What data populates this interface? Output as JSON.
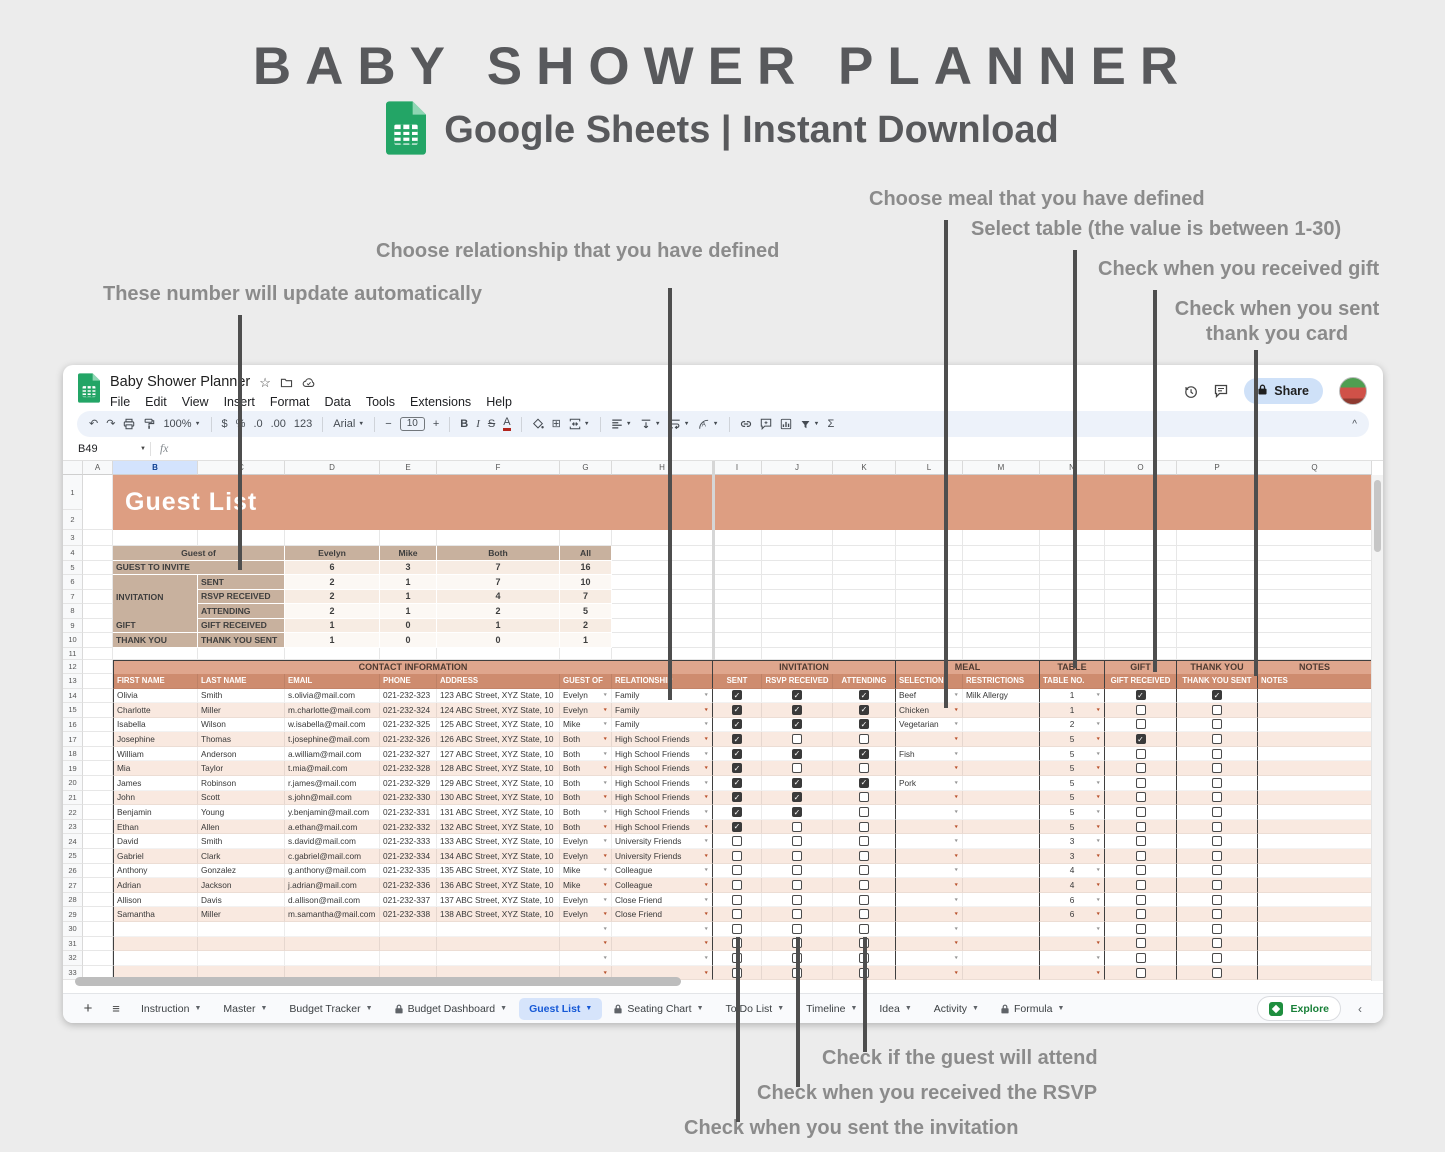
{
  "page": {
    "title": "BABY SHOWER PLANNER",
    "subtitle": "Google Sheets | Instant Download"
  },
  "annotations": {
    "auto_update": "These number will update automatically",
    "relationship": "Choose relationship that you have defined",
    "meal": "Choose meal that you have defined",
    "table": "Select table (the value is between 1-30)",
    "gift": "Check when you received gift",
    "thank_you": "Check when you sent thank you card",
    "attend": "Check if the guest will attend",
    "rsvp": "Check when you received the RSVP",
    "invitation": "Check when you sent the invitation"
  },
  "app": {
    "doc_title": "Baby Shower Planner",
    "menus": [
      "File",
      "Edit",
      "View",
      "Insert",
      "Format",
      "Data",
      "Tools",
      "Extensions",
      "Help"
    ],
    "share_label": "Share",
    "name_box": "B49",
    "fx_label": "fx"
  },
  "toolbar": {
    "items": [
      {
        "name": "undo-icon",
        "glyph": "↶"
      },
      {
        "name": "redo-icon",
        "glyph": "↷"
      },
      {
        "name": "print-icon",
        "svg": "print"
      },
      {
        "name": "paint-format-icon",
        "svg": "paint"
      },
      {
        "name": "zoom-select",
        "text": "100%",
        "caret": true
      },
      {
        "name": "sep"
      },
      {
        "name": "currency-format-icon",
        "glyph": "$"
      },
      {
        "name": "percent-format-icon",
        "glyph": "%"
      },
      {
        "name": "decrease-decimal-icon",
        "glyph": ".0"
      },
      {
        "name": "increase-decimal-icon",
        "glyph": ".00"
      },
      {
        "name": "number-format-select",
        "glyph": "123"
      },
      {
        "name": "sep"
      },
      {
        "name": "font-select",
        "text": "Arial",
        "caret": true
      },
      {
        "name": "sep"
      },
      {
        "name": "decrease-font-size-icon",
        "glyph": "−"
      },
      {
        "name": "font-size-input",
        "text": "10",
        "boxed": true
      },
      {
        "name": "increase-font-size-icon",
        "glyph": "+"
      },
      {
        "name": "sep"
      },
      {
        "name": "bold-icon",
        "glyph": "B",
        "style": "b"
      },
      {
        "name": "italic-icon",
        "glyph": "I",
        "style": "i"
      },
      {
        "name": "strikethrough-icon",
        "glyph": "S",
        "style": "strike"
      },
      {
        "name": "text-color-icon",
        "glyph": "A",
        "style": "underbar"
      },
      {
        "name": "sep"
      },
      {
        "name": "fill-color-icon",
        "svg": "fill"
      },
      {
        "name": "borders-icon",
        "glyph": "⊞"
      },
      {
        "name": "merge-cells-icon",
        "svg": "merge",
        "caret": true
      },
      {
        "name": "sep"
      },
      {
        "name": "horizontal-align-icon",
        "svg": "halign",
        "caret": true
      },
      {
        "name": "vertical-align-icon",
        "svg": "valign",
        "caret": true
      },
      {
        "name": "text-wrap-icon",
        "svg": "wrap",
        "caret": true
      },
      {
        "name": "text-rotation-icon",
        "svg": "rotate",
        "caret": true
      },
      {
        "name": "sep"
      },
      {
        "name": "insert-link-icon",
        "svg": "link"
      },
      {
        "name": "insert-comment-icon",
        "svg": "comment"
      },
      {
        "name": "insert-chart-icon",
        "svg": "chart"
      },
      {
        "name": "filter-icon",
        "svg": "filter",
        "caret": true
      },
      {
        "name": "functions-icon",
        "glyph": "Σ"
      }
    ],
    "collapse_glyph": "^"
  },
  "grid": {
    "columns": [
      "A",
      "B",
      "C",
      "D",
      "E",
      "F",
      "G",
      "H",
      "I",
      "J",
      "K",
      "L",
      "M",
      "N",
      "O",
      "P",
      "Q"
    ],
    "selected_column": "B",
    "sheet_title": "Guest List",
    "first_row": 1,
    "last_row": 33
  },
  "summary": {
    "header_label": "Guest of",
    "header_cols": [
      "Evelyn",
      "Mike",
      "Both",
      "All"
    ],
    "rows": [
      {
        "b": "GUEST TO INVITE",
        "c": null,
        "values": [
          "6",
          "3",
          "7",
          "16"
        ]
      },
      {
        "b": "",
        "c": "SENT",
        "values": [
          "2",
          "1",
          "7",
          "10"
        ]
      },
      {
        "b": "INVITATION",
        "c": "RSVP RECEIVED",
        "values": [
          "2",
          "1",
          "4",
          "7"
        ]
      },
      {
        "b": "",
        "c": "ATTENDING",
        "values": [
          "2",
          "1",
          "2",
          "5"
        ]
      },
      {
        "b": "GIFT",
        "c": "GIFT RECEIVED",
        "values": [
          "1",
          "0",
          "1",
          "2"
        ]
      },
      {
        "b": "THANK YOU",
        "c": "THANK YOU SENT",
        "values": [
          "1",
          "0",
          "0",
          "1"
        ]
      }
    ]
  },
  "table": {
    "sections": [
      {
        "label": "CONTACT INFORMATION",
        "cols": 7
      },
      {
        "label": "INVITATION",
        "cols": 3
      },
      {
        "label": "MEAL",
        "cols": 2
      },
      {
        "label": "TABLE",
        "cols": 1
      },
      {
        "label": "GIFT",
        "cols": 1
      },
      {
        "label": "THANK YOU",
        "cols": 1
      },
      {
        "label": "NOTES",
        "cols": 1
      }
    ],
    "headers": [
      "FIRST NAME",
      "LAST NAME",
      "EMAIL",
      "PHONE",
      "ADDRESS",
      "GUEST OF",
      "RELATIONSHIP",
      "SENT",
      "RSVP RECEIVED",
      "ATTENDING",
      "SELECTION",
      "RESTRICTIONS",
      "TABLE NO.",
      "GIFT RECEIVED",
      "THANK YOU SENT",
      "NOTES"
    ],
    "empty_row_count": 4
  },
  "guests": [
    {
      "first": "Olivia",
      "last": "Smith",
      "email": "s.olivia@mail.com",
      "phone": "021-232-323",
      "address": "123 ABC Street, XYZ State, 10",
      "guest_of": "Evelyn",
      "relationship": "Family",
      "sent": true,
      "rsvp_received": true,
      "attending": true,
      "meal": "Beef",
      "restrictions": "Milk Allergy",
      "table_no": "1",
      "gift_received": true,
      "thank_you_sent": true,
      "notes": ""
    },
    {
      "first": "Charlotte",
      "last": "Miller",
      "email": "m.charlotte@mail.com",
      "phone": "021-232-324",
      "address": "124 ABC Street, XYZ State, 10",
      "guest_of": "Evelyn",
      "relationship": "Family",
      "sent": true,
      "rsvp_received": true,
      "attending": true,
      "meal": "Chicken",
      "restrictions": "",
      "table_no": "1",
      "gift_received": false,
      "thank_you_sent": false,
      "notes": ""
    },
    {
      "first": "Isabella",
      "last": "Wilson",
      "email": "w.isabella@mail.com",
      "phone": "021-232-325",
      "address": "125 ABC Street, XYZ State, 10",
      "guest_of": "Mike",
      "relationship": "Family",
      "sent": true,
      "rsvp_received": true,
      "attending": true,
      "meal": "Vegetarian",
      "restrictions": "",
      "table_no": "2",
      "gift_received": false,
      "thank_you_sent": false,
      "notes": ""
    },
    {
      "first": "Josephine",
      "last": "Thomas",
      "email": "t.josephine@mail.com",
      "phone": "021-232-326",
      "address": "126 ABC Street, XYZ State, 10",
      "guest_of": "Both",
      "relationship": "High School Friends",
      "sent": true,
      "rsvp_received": false,
      "attending": false,
      "meal": "",
      "restrictions": "",
      "table_no": "5",
      "gift_received": true,
      "thank_you_sent": false,
      "notes": ""
    },
    {
      "first": "William",
      "last": "Anderson",
      "email": "a.william@mail.com",
      "phone": "021-232-327",
      "address": "127 ABC Street, XYZ State, 10",
      "guest_of": "Both",
      "relationship": "High School Friends",
      "sent": true,
      "rsvp_received": true,
      "attending": true,
      "meal": "Fish",
      "restrictions": "",
      "table_no": "5",
      "gift_received": false,
      "thank_you_sent": false,
      "notes": ""
    },
    {
      "first": "Mia",
      "last": "Taylor",
      "email": "t.mia@mail.com",
      "phone": "021-232-328",
      "address": "128 ABC Street, XYZ State, 10",
      "guest_of": "Both",
      "relationship": "High School Friends",
      "sent": true,
      "rsvp_received": false,
      "attending": false,
      "meal": "",
      "restrictions": "",
      "table_no": "5",
      "gift_received": false,
      "thank_you_sent": false,
      "notes": ""
    },
    {
      "first": "James",
      "last": "Robinson",
      "email": "r.james@mail.com",
      "phone": "021-232-329",
      "address": "129 ABC Street, XYZ State, 10",
      "guest_of": "Both",
      "relationship": "High School Friends",
      "sent": true,
      "rsvp_received": true,
      "attending": true,
      "meal": "Pork",
      "restrictions": "",
      "table_no": "5",
      "gift_received": false,
      "thank_you_sent": false,
      "notes": ""
    },
    {
      "first": "John",
      "last": "Scott",
      "email": "s.john@mail.com",
      "phone": "021-232-330",
      "address": "130 ABC Street, XYZ State, 10",
      "guest_of": "Both",
      "relationship": "High School Friends",
      "sent": true,
      "rsvp_received": true,
      "attending": false,
      "meal": "",
      "restrictions": "",
      "table_no": "5",
      "gift_received": false,
      "thank_you_sent": false,
      "notes": ""
    },
    {
      "first": "Benjamin",
      "last": "Young",
      "email": "y.benjamin@mail.com",
      "phone": "021-232-331",
      "address": "131 ABC Street, XYZ State, 10",
      "guest_of": "Both",
      "relationship": "High School Friends",
      "sent": true,
      "rsvp_received": true,
      "attending": false,
      "meal": "",
      "restrictions": "",
      "table_no": "5",
      "gift_received": false,
      "thank_you_sent": false,
      "notes": ""
    },
    {
      "first": "Ethan",
      "last": "Allen",
      "email": "a.ethan@mail.com",
      "phone": "021-232-332",
      "address": "132 ABC Street, XYZ State, 10",
      "guest_of": "Both",
      "relationship": "High School Friends",
      "sent": true,
      "rsvp_received": false,
      "attending": false,
      "meal": "",
      "restrictions": "",
      "table_no": "5",
      "gift_received": false,
      "thank_you_sent": false,
      "notes": ""
    },
    {
      "first": "David",
      "last": "Smith",
      "email": "s.david@mail.com",
      "phone": "021-232-333",
      "address": "133 ABC Street, XYZ State, 10",
      "guest_of": "Evelyn",
      "relationship": "University Friends",
      "sent": false,
      "rsvp_received": false,
      "attending": false,
      "meal": "",
      "restrictions": "",
      "table_no": "3",
      "gift_received": false,
      "thank_you_sent": false,
      "notes": ""
    },
    {
      "first": "Gabriel",
      "last": "Clark",
      "email": "c.gabriel@mail.com",
      "phone": "021-232-334",
      "address": "134 ABC Street, XYZ State, 10",
      "guest_of": "Evelyn",
      "relationship": "University Friends",
      "sent": false,
      "rsvp_received": false,
      "attending": false,
      "meal": "",
      "restrictions": "",
      "table_no": "3",
      "gift_received": false,
      "thank_you_sent": false,
      "notes": ""
    },
    {
      "first": "Anthony",
      "last": "Gonzalez",
      "email": "g.anthony@mail.com",
      "phone": "021-232-335",
      "address": "135 ABC Street, XYZ State, 10",
      "guest_of": "Mike",
      "relationship": "Colleague",
      "sent": false,
      "rsvp_received": false,
      "attending": false,
      "meal": "",
      "restrictions": "",
      "table_no": "4",
      "gift_received": false,
      "thank_you_sent": false,
      "notes": ""
    },
    {
      "first": "Adrian",
      "last": "Jackson",
      "email": "j.adrian@mail.com",
      "phone": "021-232-336",
      "address": "136 ABC Street, XYZ State, 10",
      "guest_of": "Mike",
      "relationship": "Colleague",
      "sent": false,
      "rsvp_received": false,
      "attending": false,
      "meal": "",
      "restrictions": "",
      "table_no": "4",
      "gift_received": false,
      "thank_you_sent": false,
      "notes": ""
    },
    {
      "first": "Allison",
      "last": "Davis",
      "email": "d.allison@mail.com",
      "phone": "021-232-337",
      "address": "137 ABC Street, XYZ State, 10",
      "guest_of": "Evelyn",
      "relationship": "Close Friend",
      "sent": false,
      "rsvp_received": false,
      "attending": false,
      "meal": "",
      "restrictions": "",
      "table_no": "6",
      "gift_received": false,
      "thank_you_sent": false,
      "notes": ""
    },
    {
      "first": "Samantha",
      "last": "Miller",
      "email": "m.samantha@mail.com",
      "phone": "021-232-338",
      "address": "138 ABC Street, XYZ State, 10",
      "guest_of": "Evelyn",
      "relationship": "Close Friend",
      "sent": false,
      "rsvp_received": false,
      "attending": false,
      "meal": "",
      "restrictions": "",
      "table_no": "6",
      "gift_received": false,
      "thank_you_sent": false,
      "notes": ""
    }
  ],
  "tabs": {
    "items": [
      {
        "label": "Instruction"
      },
      {
        "label": "Master"
      },
      {
        "label": "Budget Tracker"
      },
      {
        "label": "Budget Dashboard",
        "locked": true
      },
      {
        "label": "Guest List",
        "active": true
      },
      {
        "label": "Seating Chart",
        "locked": true
      },
      {
        "label": "To Do List"
      },
      {
        "label": "Timeline"
      },
      {
        "label": "Idea"
      },
      {
        "label": "Activity"
      },
      {
        "label": "Formula",
        "locked": true
      }
    ],
    "explore_label": "Explore"
  },
  "colors": {
    "banner_salmon": "#dd9e82",
    "section_salmon": "#dfa68d",
    "header_salmon": "#ce8c6f",
    "summary_tan": "#c8b19e",
    "peach_row": "#f9e9e0",
    "sheets_green": "#23a566",
    "active_tab_blue": "#1558d6",
    "share_blue": "#cfe1f8",
    "explore_green": "#1e8e3e"
  }
}
